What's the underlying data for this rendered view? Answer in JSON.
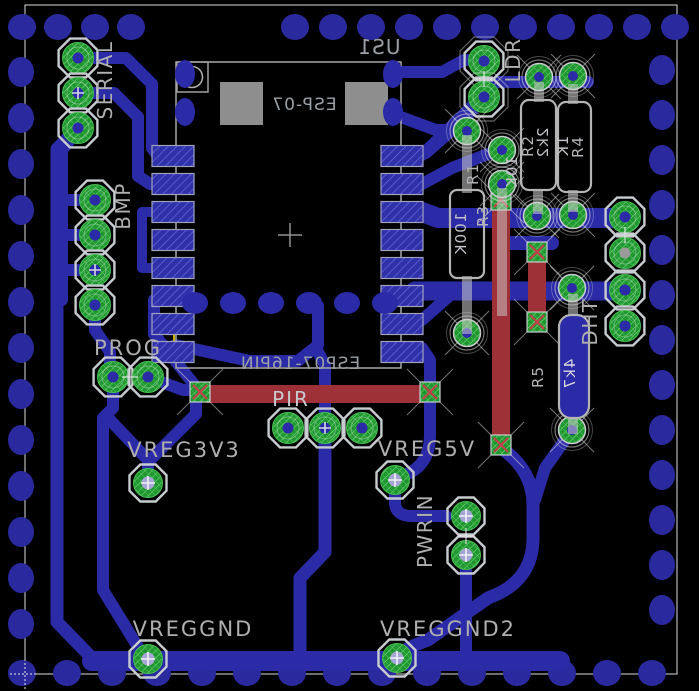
{
  "colors": {
    "board-bg": "#000000",
    "copper-bottom": "#2B2BA8",
    "copper-bottom-dim": "#2A2A9E",
    "copper-top": "#9E3038",
    "pad-green": "#1F9630",
    "pad-green-hatch": "#72D879",
    "smd-blue": "#3030A8",
    "smd-blue-hatch": "#6A6AE0",
    "silkscreen": "#AFAFAF",
    "module-silk": "#9AA0A6",
    "frame": "#DCDCDC",
    "airwire": "#C8B400",
    "via-red": "#C2404A",
    "hole-blue": "#2B2BA8",
    "hole-light": "#A6A6D6",
    "gray-block": "#8E8E8E"
  },
  "module": {
    "ref": "US1",
    "value": "ESP-07",
    "footprint_label": "ESP07-16PIN"
  },
  "connectors": {
    "serial": {
      "label": "SERIAL"
    },
    "bmp": {
      "label": "BMP"
    },
    "prog": {
      "label": "PROG"
    },
    "pir": {
      "label": "PIR"
    },
    "ldr": {
      "label": "LDR"
    },
    "dht": {
      "label": "DHT"
    },
    "pwrin": {
      "label": "PWRIN"
    },
    "vreg3v3": {
      "label": "VREG3V3"
    },
    "vreg5v": {
      "label": "VREG5V"
    },
    "vreggnd": {
      "label": "VREGGND"
    },
    "vreggnd2": {
      "label": "VREGGND2"
    }
  },
  "resistors": {
    "r1": {
      "ref": "R1",
      "value": "100K"
    },
    "r2": {
      "ref": "R2",
      "value": "2k2"
    },
    "r3": {
      "ref": "R3",
      "value": "10K"
    },
    "r4": {
      "ref": "R4",
      "value": "1K"
    },
    "r5": {
      "ref": "R5",
      "value": "4k7"
    }
  }
}
